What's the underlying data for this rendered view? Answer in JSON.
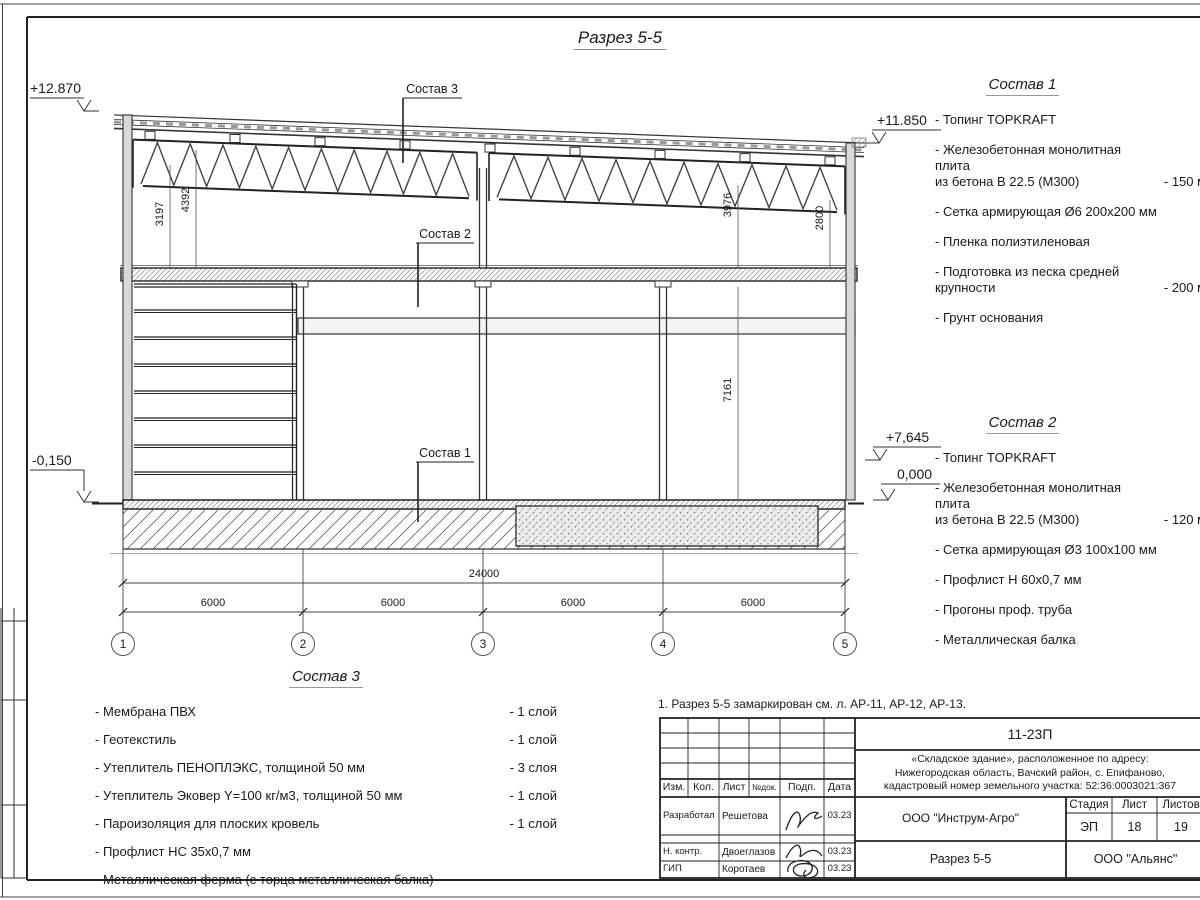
{
  "title": "Разрез 5-5",
  "note": "1. Разрез 5-5 замаркирован см. л. АР-11, АР-12, АР-13.",
  "elevations": {
    "roof_left": "+12.870",
    "roof_right": "+11.850",
    "truss_right": "+7,645",
    "ground_left": "-0,150",
    "ground_right": "0,000"
  },
  "dims": {
    "total": "24000",
    "span1": "6000",
    "span2": "6000",
    "span3": "6000",
    "span4": "6000",
    "v_3197": "3197",
    "v_4392": "4392",
    "v_3976": "3976",
    "v_2800": "2800",
    "v_7161": "7161"
  },
  "axes": {
    "a1": "1",
    "a2": "2",
    "a3": "3",
    "a4": "4",
    "a5": "5"
  },
  "callouts": {
    "c1": "Состав 1",
    "c2": "Состав 2",
    "c3": "Состав 3"
  },
  "sostav1": {
    "title": "Состав 1",
    "items": [
      {
        "name": "- Топинг TOPKRAFT",
        "value": ""
      },
      {
        "name": "- Железобетонная  монолитная плита\nиз бетона  В 22.5 (М300)",
        "value": "- 150 мм"
      },
      {
        "name": "- Сетка армирующая Ø6 200х200 мм",
        "value": ""
      },
      {
        "name": "- Пленка полиэтиленовая",
        "value": ""
      },
      {
        "name": "- Подготовка из песка средней\nкрупности",
        "value": "- 200 мм"
      },
      {
        "name": "- Грунт основания",
        "value": ""
      }
    ]
  },
  "sostav2": {
    "title": "Состав 2",
    "items": [
      {
        "name": "- Топинг TOPKRAFT",
        "value": ""
      },
      {
        "name": "- Железобетонная  монолитная плита\nиз бетона  В 22.5 (М300)",
        "value": "- 120 мм"
      },
      {
        "name": "- Сетка армирующая Ø3 100х100 мм",
        "value": ""
      },
      {
        "name": "- Профлист Н 60х0,7 мм",
        "value": ""
      },
      {
        "name": "- Прогоны проф. труба",
        "value": ""
      },
      {
        "name": "- Металлическая балка",
        "value": ""
      }
    ]
  },
  "sostav3": {
    "title": "Состав 3",
    "items": [
      {
        "name": "- Мембрана ПВХ",
        "value": "- 1 слой"
      },
      {
        "name": "- Геотекстиль",
        "value": "- 1 слой"
      },
      {
        "name": "- Утеплитель ПЕНОПЛЭКС, толщиной 50 мм",
        "value": "- 3 слоя"
      },
      {
        "name": "- Утеплитель Эковер Y=100 кг/м3, толщиной 50 мм",
        "value": "- 1 слой"
      },
      {
        "name": "- Пароизоляция для плоских кровель",
        "value": "- 1 слой"
      },
      {
        "name": "- Профлист НС 35х0,7 мм",
        "value": ""
      },
      {
        "name": "- Металлическая ферма (с торца металлическая балка)",
        "value": ""
      }
    ]
  },
  "title_block": {
    "doc_number": "11-23П",
    "project_line1": "«Складское здание», расположенное по адресу:",
    "project_line2": "Нижегородская область, Вачский район, с. Епифаново,",
    "project_line3": "кадастровый номер земельного участка: 52:36:0003021:367",
    "col_izm": "Изм.",
    "col_kol": "Кол.",
    "col_list": "Лист",
    "col_doc": "№док.",
    "col_podp": "Подп.",
    "col_data": "Дата",
    "row1_role": "Разработал",
    "row1_name": "Решетова",
    "row1_date": "03.23",
    "row2_role": "Н. контр.",
    "row2_name": "Двоеглазов",
    "row2_date": "03.23",
    "row3_role": "ГИП",
    "row3_name": "Коротаев",
    "row3_date": "03.23",
    "company": "ООО \"Инструм-Агро\"",
    "stage_label": "Стадия",
    "list_label": "Лист",
    "listov_label": "Листов",
    "stage": "ЭП",
    "list": "18",
    "listov": "19",
    "drawing_name": "Разрез 5-5",
    "org": "ООО \"Альянс\""
  }
}
